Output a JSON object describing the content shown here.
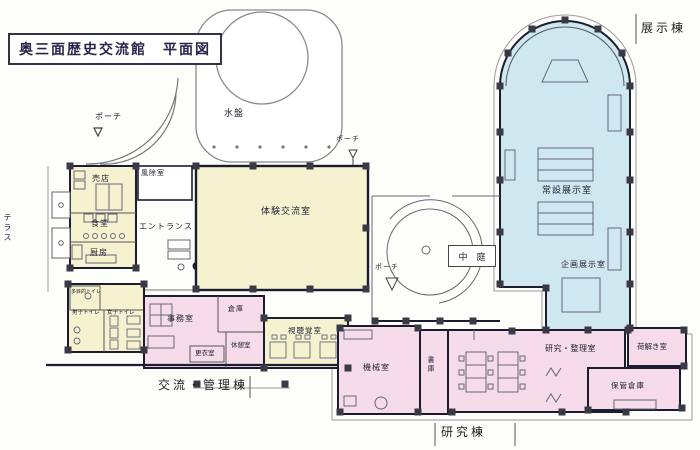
{
  "title": "奥三面歴史交流館　平面図",
  "wings": {
    "exhibition": "展示棟",
    "management": "交流・管理棟",
    "research": "研究棟"
  },
  "rooms": {
    "water_basin": "水盤",
    "porch": "ポーチ",
    "shop": "売店",
    "vestibule": "風除室",
    "terrace": "テラス",
    "dining": "食堂",
    "kitchen": "厨房",
    "entrance": "エントランス",
    "experience_room": "体験交流室",
    "permanent_exhibition": "常設展示室",
    "planned_exhibition": "企画展示室",
    "courtyard": "中　庭",
    "accessible_toilet": "多目的トイレ",
    "mens_toilet": "男子トイレ",
    "womens_toilet": "女子トイレ",
    "office": "事務室",
    "storeroom": "倉庫",
    "changing_room": "更衣室",
    "rest_room": "休憩室",
    "av_room": "視聴覚室",
    "machine_room": "機械室",
    "stacks": "書庫",
    "research_sorting_room": "研究・整理室",
    "unpacking_room": "荷解き室",
    "storage_warehouse": "保管倉庫"
  },
  "colors": {
    "wall": "#1c1c30",
    "column": "#3a3a46",
    "yellow_zone": "#f6f2d0",
    "blue_zone": "#cfe8f0",
    "pink_zone": "#f6dcea",
    "thin_line": "#9a9a9a",
    "furniture_line": "#666677"
  }
}
